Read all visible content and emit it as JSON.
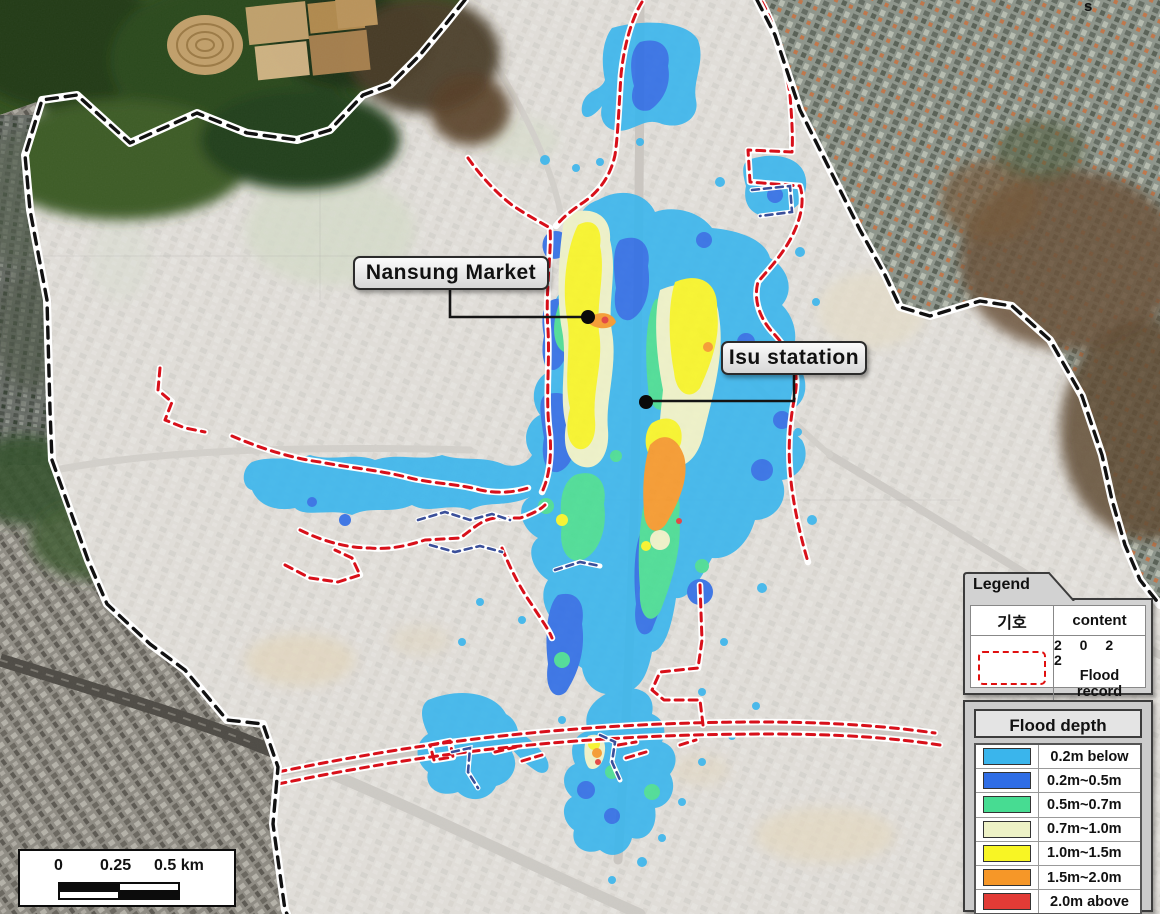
{
  "map": {
    "annotations": [
      {
        "label": "Nansung Market"
      },
      {
        "label": "Isu statation"
      }
    ],
    "stray_mark": "s"
  },
  "legend": {
    "title": "Legend",
    "symbol_header": "기호",
    "content_header": "content",
    "record_year": "2 0 2 2",
    "record_label": "Flood record",
    "record_symbol_color": "#e01010"
  },
  "flood_depth": {
    "title": "Flood depth",
    "classes": [
      {
        "label": "0.2m below",
        "color": "#3ab5ec"
      },
      {
        "label": "0.2m~0.5m",
        "color": "#2f6de5"
      },
      {
        "label": "0.5m~0.7m",
        "color": "#47dc92"
      },
      {
        "label": "0.7m~1.0m",
        "color": "#eef2c6"
      },
      {
        "label": "1.0m~1.5m",
        "color": "#f8f524"
      },
      {
        "label": "1.5m~2.0m",
        "color": "#f69728"
      },
      {
        "label": "2.0m above",
        "color": "#e23b36"
      }
    ]
  },
  "scale_bar": {
    "labels": [
      "0",
      "0.25",
      "0.5 km"
    ]
  },
  "colors": {
    "boundary_dash": "#111111",
    "boundary_casing": "#ffffff",
    "flood_record_line": "#d8101a",
    "subway_dash": "#3a4f9a"
  }
}
